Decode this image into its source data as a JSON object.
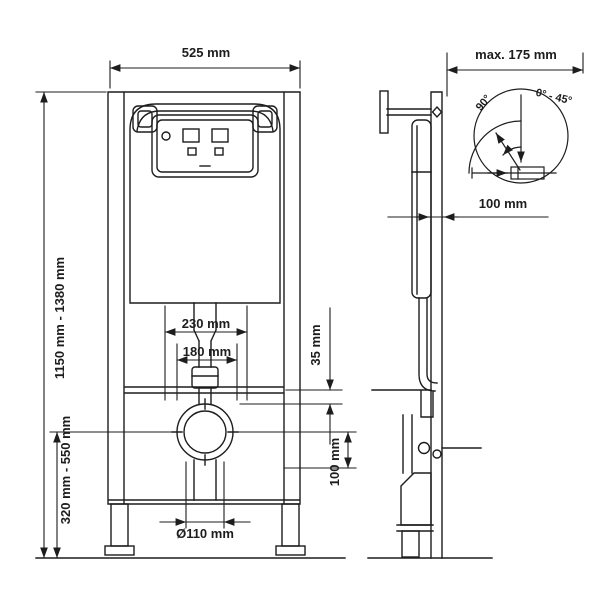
{
  "drawing": {
    "background": "#ffffff",
    "line_color": "#1d1d1d",
    "front_view": {
      "frame_width": "525 mm",
      "frame_height_range": "1150 mm - 1380 mm",
      "fixing_bolt_spacing_outer": "230 mm",
      "fixing_bolt_spacing_inner": "180 mm",
      "bracket_offset": "35 mm",
      "outlet_offset": "100 mm",
      "outlet_height_range": "320 mm - 550 mm",
      "drain_pipe_diameter": "Ø110 mm"
    },
    "side_view": {
      "max_depth": "max. 175 mm",
      "pipe_offset": "100 mm",
      "detail_circle": {
        "arc_angle": "90°",
        "swivel_range": "0° - 45°"
      }
    }
  }
}
